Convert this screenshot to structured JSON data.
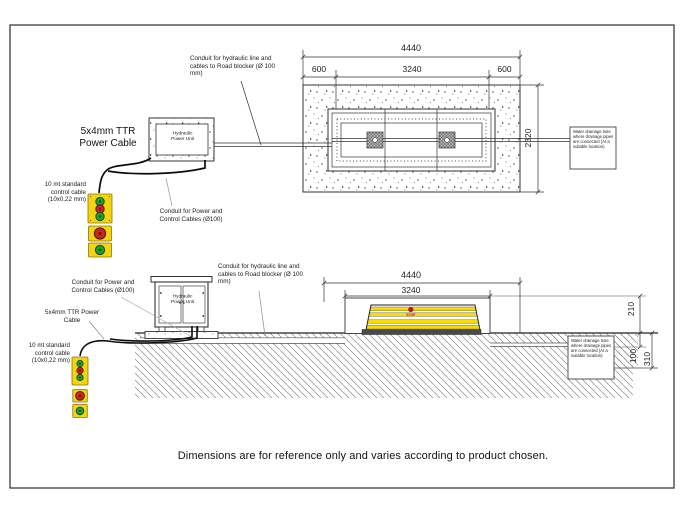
{
  "drawing": {
    "footer_note": "Dimensions are for reference only and varies according to product chosen.",
    "labels": {
      "conduit_hydraulic": "Conduit for hydraulic line and cables to Road blocker (Ø 100 mm)",
      "conduit_power_control": "Conduit for Power and Control Cables (Ø100)",
      "power_cable": "5x4mm TTR Power Cable",
      "control_cable": "10 mt standard control cable (10x0,22 mm)",
      "hydraulic_power_unit": "Hydraulic Power Unit",
      "drainage_note": "Water drainage hole where drainage pipes are connected (At a suitable location)",
      "stop_sign": "STOP"
    },
    "plan_view": {
      "dim_overall": "4440",
      "dim_left_margin": "600",
      "dim_blocker": "3240",
      "dim_right_margin": "600",
      "dim_depth": "2320"
    },
    "elevation_view": {
      "dim_overall": "4440",
      "dim_blocker": "3240",
      "dim_height_above": "210",
      "dim_surface_layer": "100",
      "dim_pit_depth": "310"
    },
    "colors": {
      "line": "#3a3a3a",
      "stripe_yellow": "#f6dc00",
      "button_red": "#c62822",
      "button_green": "#1ca32c",
      "panel_yellow": "#f2d411"
    }
  }
}
